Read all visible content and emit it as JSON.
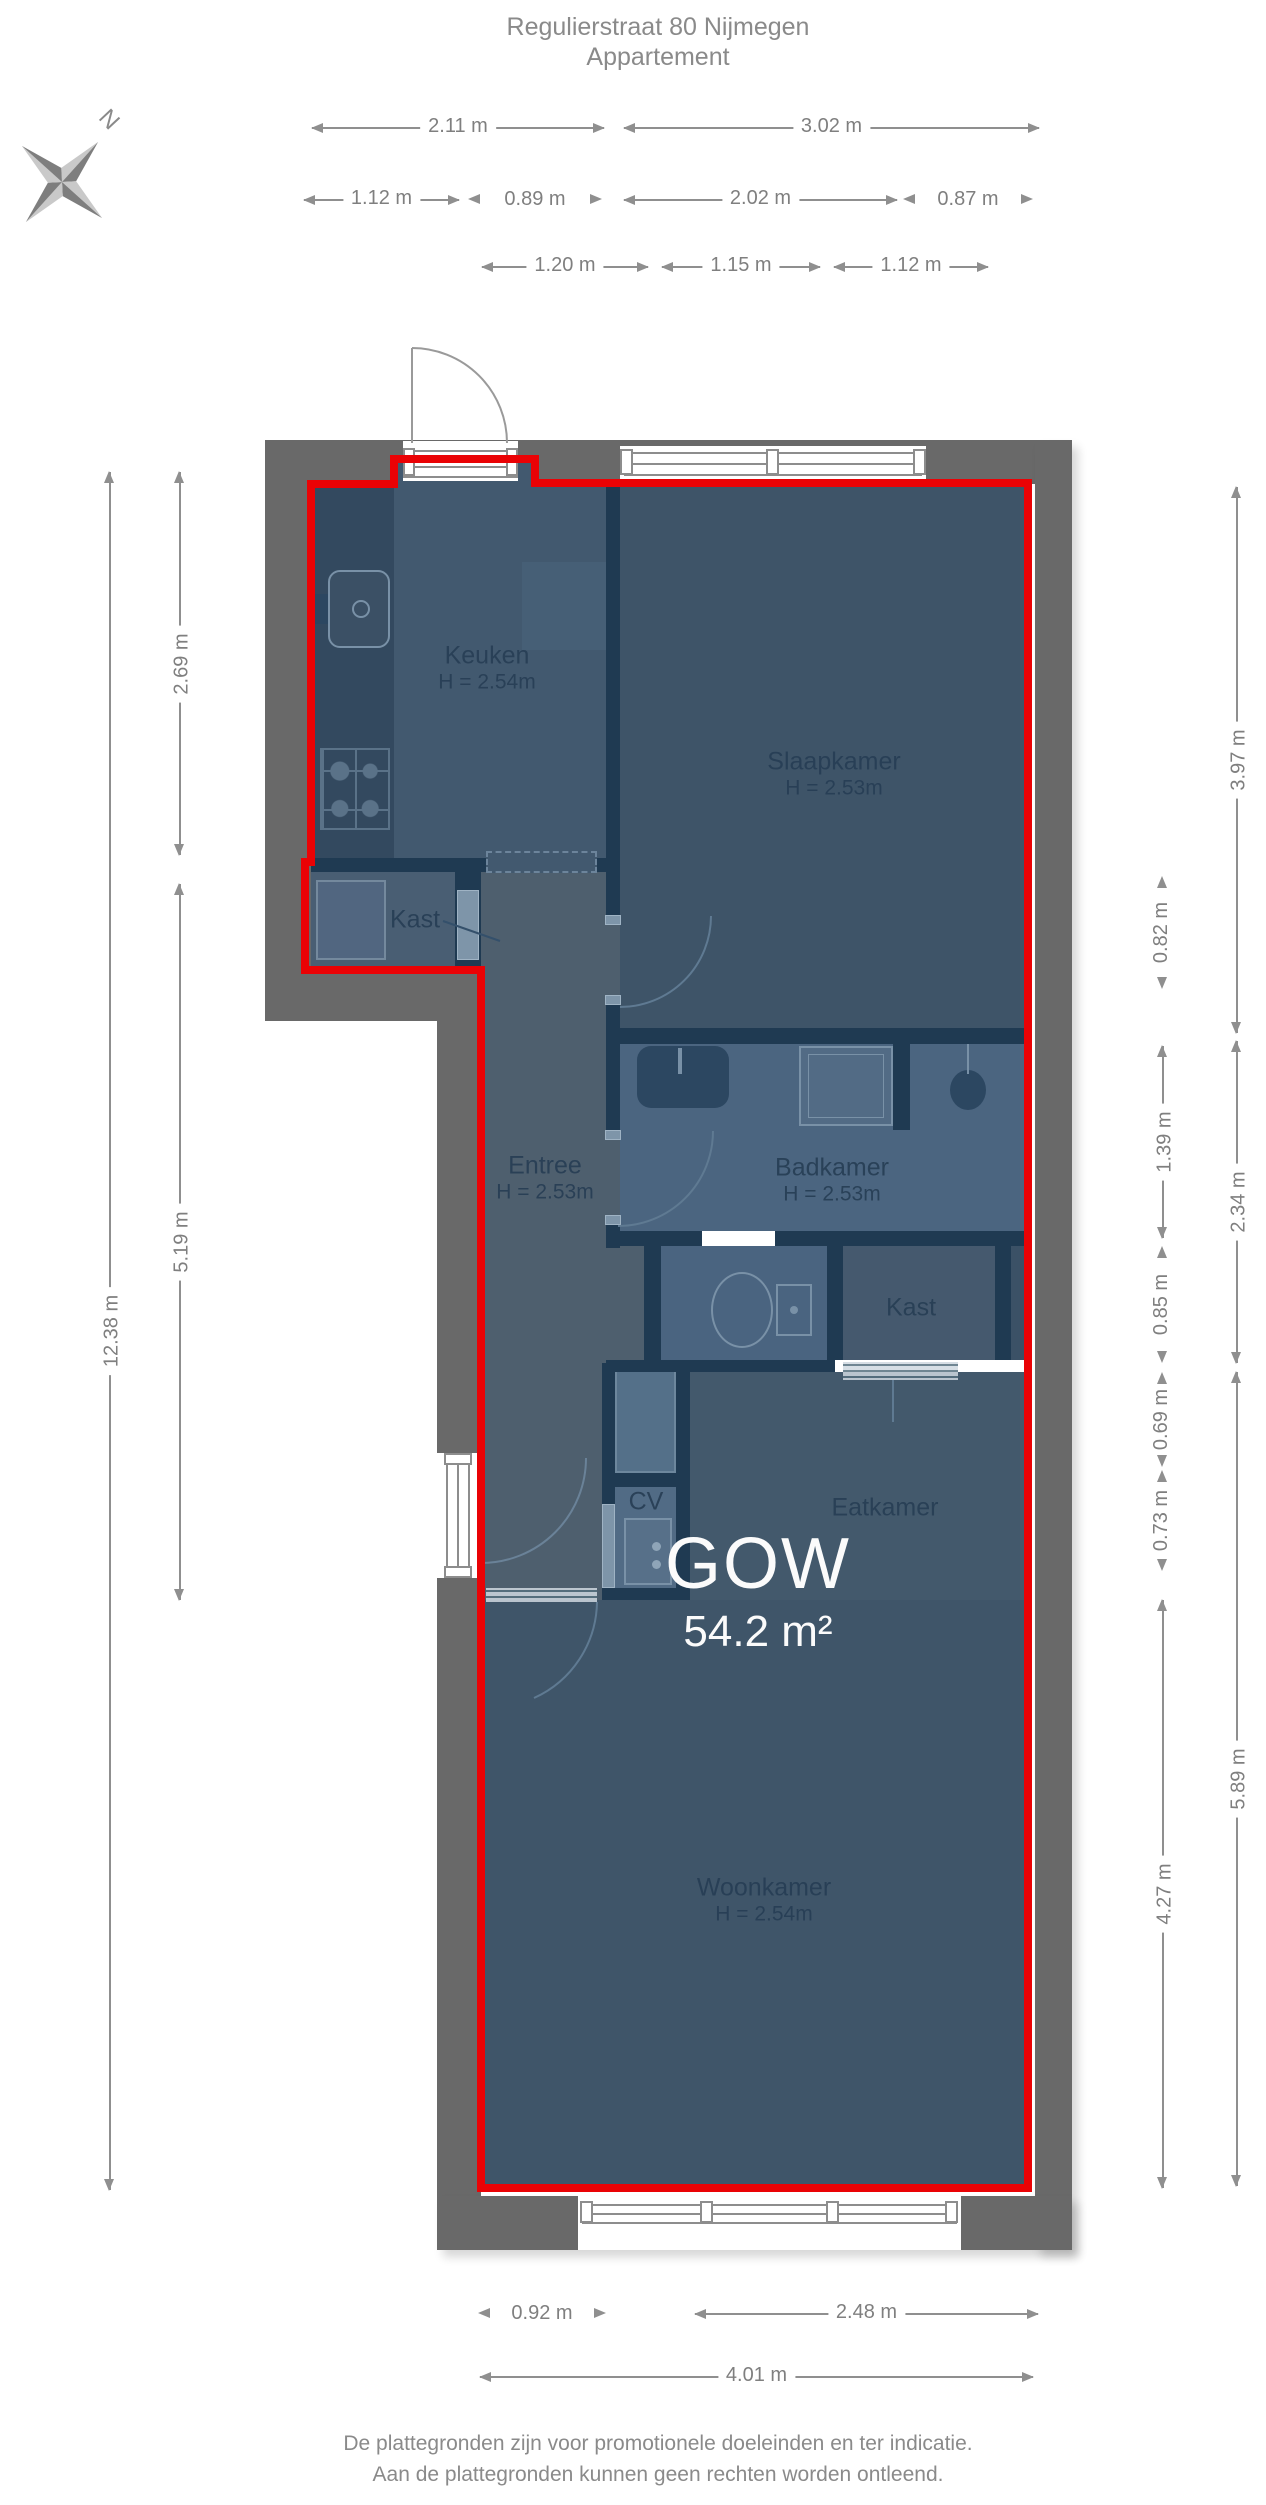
{
  "title": {
    "line1": "Regulierstraat 80 Nijmegen",
    "line2": "Appartement"
  },
  "compass": {
    "north_label": "N"
  },
  "dims": {
    "top_row1": {
      "a": "2.11 m",
      "b": "3.02 m"
    },
    "top_row2": {
      "a": "1.12 m",
      "b": "0.89 m",
      "c": "2.02 m",
      "d": "0.87 m"
    },
    "top_row3": {
      "a": "1.20 m",
      "b": "1.15 m",
      "c": "1.12 m"
    },
    "left": {
      "total": "12.38 m",
      "a": "2.69 m",
      "b": "5.19 m"
    },
    "right_outer": {
      "a": "3.97 m",
      "b": "2.34 m",
      "c": "5.89 m"
    },
    "right_inner": {
      "a": "0.82 m",
      "b": "1.39 m",
      "c": "0.85 m",
      "d": "0.69 m",
      "e": "0.73 m",
      "f": "4.27 m"
    },
    "bottom": {
      "a": "0.92 m",
      "b": "2.48 m",
      "c": "4.01 m"
    }
  },
  "rooms": {
    "keuken": {
      "name": "Keuken",
      "height": "H = 2.54m"
    },
    "slaapkamer": {
      "name": "Slaapkamer",
      "height": "H = 2.53m"
    },
    "kast1": {
      "name": "Kast"
    },
    "entree": {
      "name": "Entree",
      "height": "H = 2.53m"
    },
    "badkamer": {
      "name": "Badkamer",
      "height": "H = 2.53m"
    },
    "kast2": {
      "name": "Kast"
    },
    "eatkamer": {
      "name": "Eatkamer"
    },
    "cv": {
      "name": "CV"
    },
    "woonkamer": {
      "name": "Woonkamer",
      "height": "H = 2.54m"
    }
  },
  "area_label": {
    "name": "GOW",
    "area": "54.2 m²"
  },
  "footer": {
    "line1": "De plattegronden zijn voor promotionele doeleinden en ter indicatie.",
    "line2": "Aan de plattegronden kunnen geen rechten worden ontleend."
  },
  "colors": {
    "outline_red": "#ea0205",
    "wall_gray": "#696969",
    "room_navy": "#3e5468",
    "room_light": "#4b6580",
    "internal_wall": "#1f3a52",
    "text_muted": "#8a8a8a",
    "label_navy": "#273e55",
    "area_text": "#fbfbfb"
  }
}
